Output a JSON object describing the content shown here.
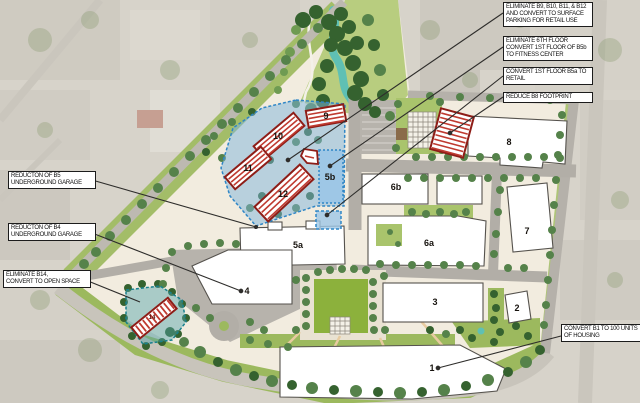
{
  "map": {
    "type": "redevelopment-site-plan",
    "building_labels": {
      "b1": "1",
      "b2": "2",
      "b3": "3",
      "b4": "4",
      "b5a": "5a",
      "b5b": "5b",
      "b6a": "6a",
      "b6b": "6b",
      "b7": "7",
      "b8": "8",
      "b9": "9",
      "b10": "10",
      "b11": "11",
      "b12": "12",
      "b14": "14"
    },
    "callouts": {
      "eliminate_b9_b12": "ELIMINATE B9, B10, B11, & B12\nAND CONVERT TO SURFACE\nPARKING FOR RETAIL USE",
      "eliminate_6th_floor_b5b": "ELIMINATE 6TH FLOOR\nCONVERT 1ST FLOOR OF B5b\nTO FITNESS CENTER",
      "convert_b5a_retail": "CONVERT 1ST FLOOR B5a TO\nRETAIL",
      "reduce_b8": "REDUCE B8 FOOTPRINT",
      "reduction_b5_garage": "REDUCTON OF B5\nUNDERGROUND GARAGE",
      "reduction_b4_garage": "REDUCTON OF B4\nUNDERGROUND GARAGE",
      "eliminate_b14": "ELIMINATE B14,\nCONVERT TO OPEN SPACE",
      "convert_b1_housing": "CONVERT B1 TO 100 UNITS\nOF HOUSING"
    },
    "colors": {
      "hatch_red_border": "#8e1d17",
      "hatch_red_stripe": "#bf3a30",
      "overlay_blue": "#7db4dc",
      "overlay_teal": "#4fa3ab",
      "water_teal": "#5fc0b4",
      "lawn_green": "#8cb13c"
    }
  }
}
